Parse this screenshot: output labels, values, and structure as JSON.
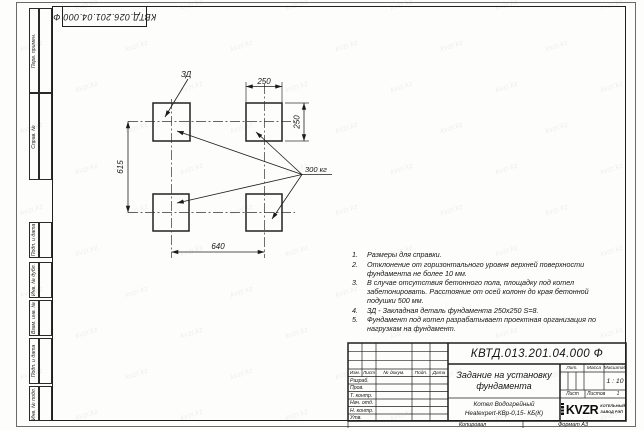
{
  "sheet": {
    "top_stamp": "КВТД.026.201.04.000 Ф",
    "watermark_text": "kvzr.kz"
  },
  "margin_strips": [
    {
      "label": "Перв. примен."
    },
    {
      "label": "Справ. №"
    },
    {
      "label": "Подп. и дата"
    },
    {
      "label": "Инв. № дубл."
    },
    {
      "label": "Взам. инв. №"
    },
    {
      "label": "Подп. и дата"
    },
    {
      "label": "Инв. № подл."
    }
  ],
  "figure": {
    "dim_top": "250",
    "dim_right": "250",
    "dim_left": "615",
    "dim_bottom": "640",
    "embed_label": "ЗД",
    "load_label": "300 кг"
  },
  "notes": [
    {
      "num": "1.",
      "text": "Размеры для справки."
    },
    {
      "num": "2.",
      "text": "Отклонение от горизонтального уровня верхней поверхности фундамента не более 10 мм."
    },
    {
      "num": "3.",
      "text": "В случае отсутствия бетонного пола, площадку под котел забетонировать. Расстояние от осей колонн до края бетонной подушки 500 мм."
    },
    {
      "num": "4.",
      "text": "ЗД - Закладная деталь фундамента 250х250 S=8."
    },
    {
      "num": "5.",
      "text": "Фундамент под котел разрабатывает проектная организация по нагрузкам на фундамент."
    }
  ],
  "titleblock": {
    "doc_number": "КВТД.013.201.04.000 Ф",
    "title": "Задание на установку фундамента",
    "product_line1": "Котел Водогрейный",
    "product_line2": "Heatexpert-КВр-0,15- КБ(К)",
    "col_izm": "Изм.",
    "col_list": "Лист",
    "col_docnum": "№ докум.",
    "col_sign": "Подп.",
    "col_date": "Дата",
    "row_developed": "Разраб.",
    "row_checked": "Пров.",
    "row_tcontrol": "Т. контр.",
    "row_dept": "Нач. отд.",
    "row_ncontrol": "Н. контр.",
    "row_approved": "Утв.",
    "lit_label": "Лит.",
    "mass_label": "Масса",
    "scale_label": "Масштаб",
    "scale_value": "1 : 10",
    "sheet_label": "Лист",
    "sheets_label": "Листов",
    "sheets_value": "1",
    "logo_text": "KVZR",
    "logo_caption_line1": "КОТЕЛЬНЫЙ",
    "logo_caption_line2": "ЗАВОД РЭП"
  },
  "footer": {
    "copied_label": "Копировал",
    "format_label": "Формат А3"
  }
}
